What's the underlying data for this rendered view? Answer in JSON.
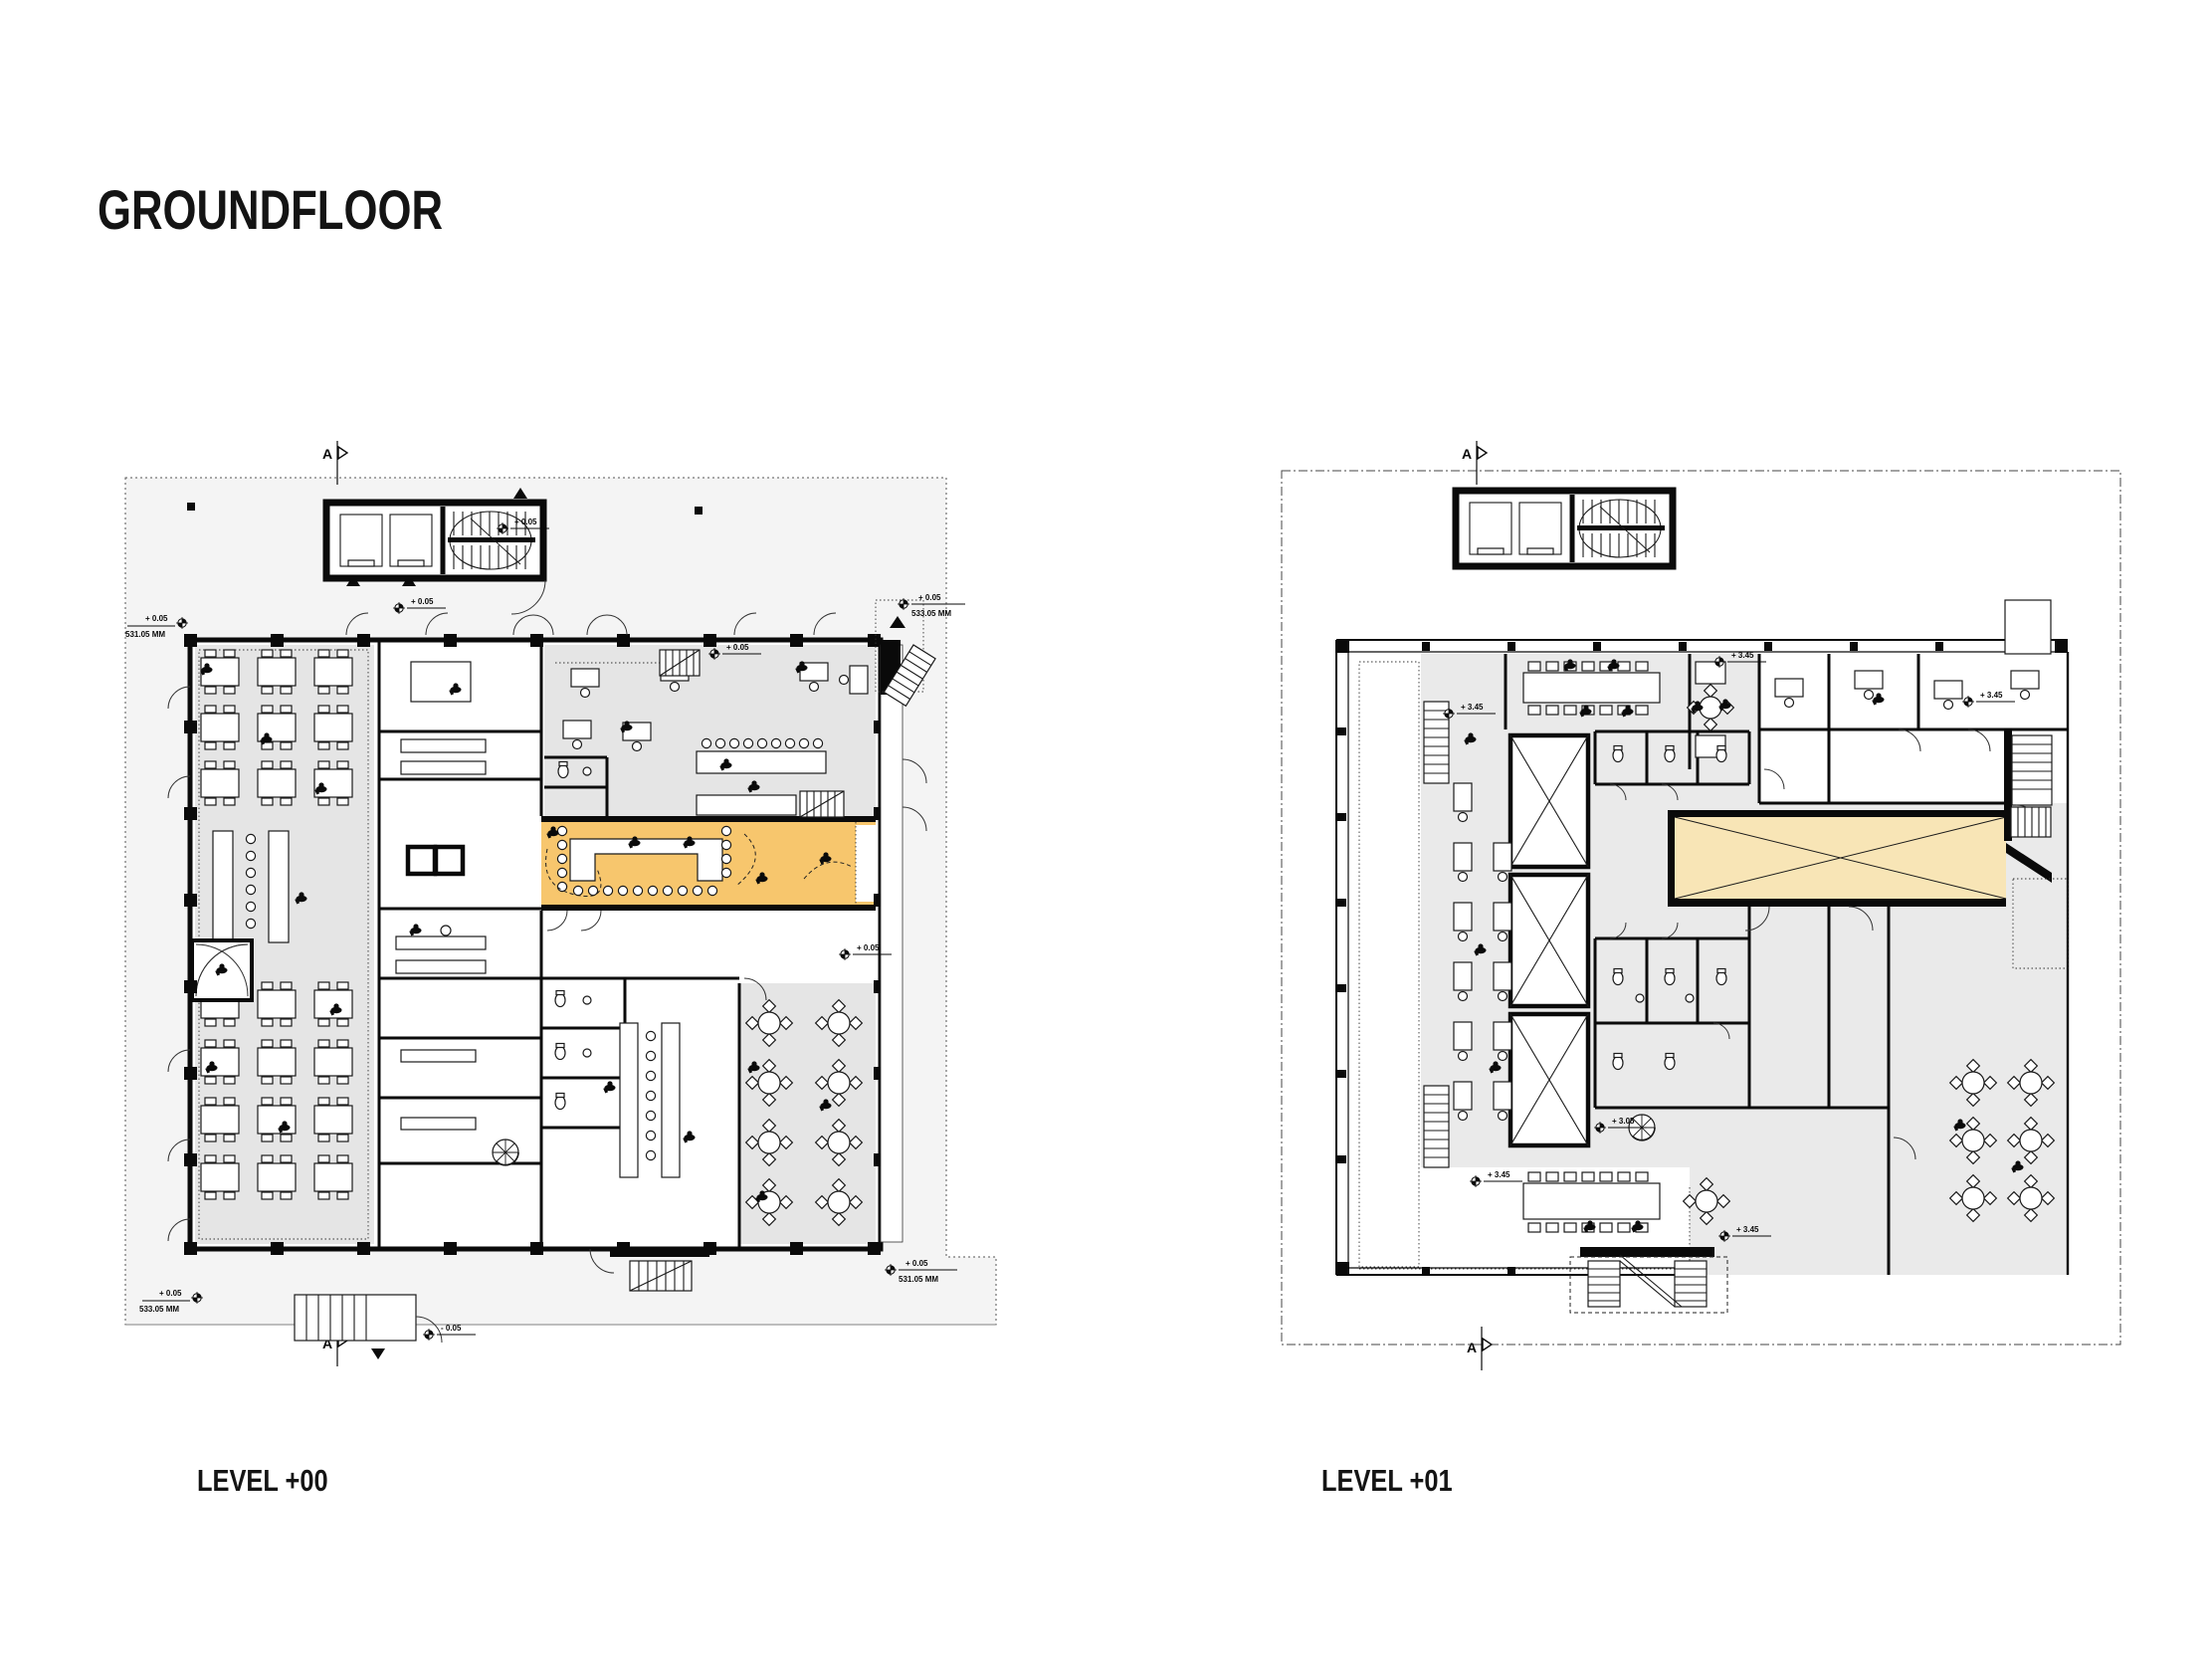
{
  "page": {
    "title": "GROUNDFLOOR"
  },
  "plans": {
    "left": {
      "label": "LEVEL +00",
      "section_marker": "A",
      "annotations": {
        "lvl": "+ 0.05",
        "lvl_neg": "- 0.05",
        "dim_a": "531.05 MM",
        "dim_b": "533.05 MM"
      },
      "highlight_meaning": "highlighted reception / bar zone"
    },
    "right": {
      "label": "LEVEL +01",
      "section_marker": "A",
      "annotations": {
        "lvl": "+ 3.45",
        "lvl_mid": "+ 3.05"
      },
      "highlight_meaning": "double-height void over level 00 highlight"
    }
  },
  "colors": {
    "highlight_level_00": "#F7C66D",
    "highlight_level_01": "#F8E5B6",
    "floor_gray": "#E5E5E5",
    "site_gray": "#F4F4F4",
    "wall_black": "#0A0A0A"
  }
}
